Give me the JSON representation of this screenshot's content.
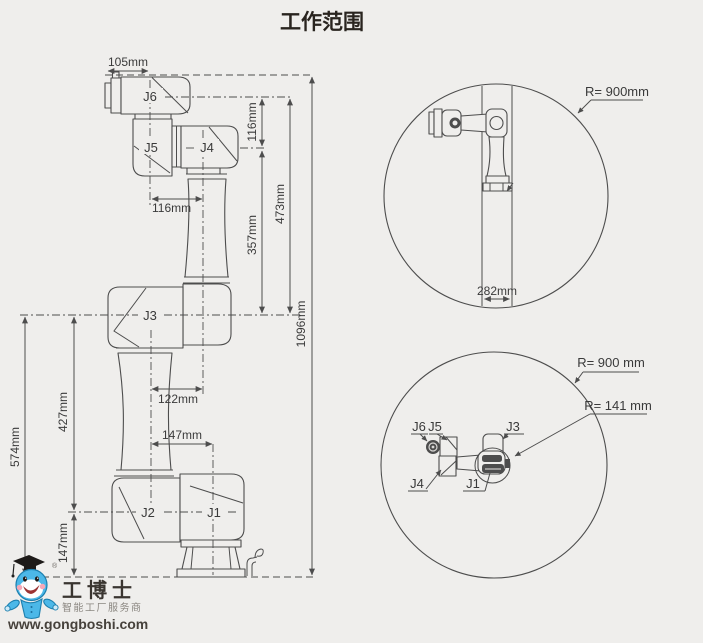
{
  "title": "工作范围",
  "side_view": {
    "labels": {
      "j1": "J1",
      "j2": "J2",
      "j3": "J3",
      "j4": "J4",
      "j5": "J5",
      "j6": "J6"
    },
    "dims": {
      "d105": "105mm",
      "d116_v": "116mm",
      "d116_h": "116mm",
      "d357": "357mm",
      "d473": "473mm",
      "d1096": "1096mm",
      "d122": "122mm",
      "d147_h": "147mm",
      "d574": "574mm",
      "d427": "427mm",
      "d147_v": "147mm"
    }
  },
  "front_envelope": {
    "radius": "R= 900mm",
    "column_width": "282mm"
  },
  "top_envelope": {
    "outer_radius": "R= 900 mm",
    "inner_radius": "R= 141 mm",
    "labels": {
      "j1": "J1",
      "j3": "J3",
      "j4": "J4",
      "j5": "J5",
      "j6": "J6"
    }
  },
  "logo": {
    "registered": "®",
    "brand": "工博士",
    "tagline": "智能工厂服务商",
    "website": "www.gongboshi.com"
  },
  "colors": {
    "background": "#efeeec",
    "line": "#4d4d4d",
    "text": "#3a3a3a",
    "logo_blue": "#4cb8e8"
  }
}
